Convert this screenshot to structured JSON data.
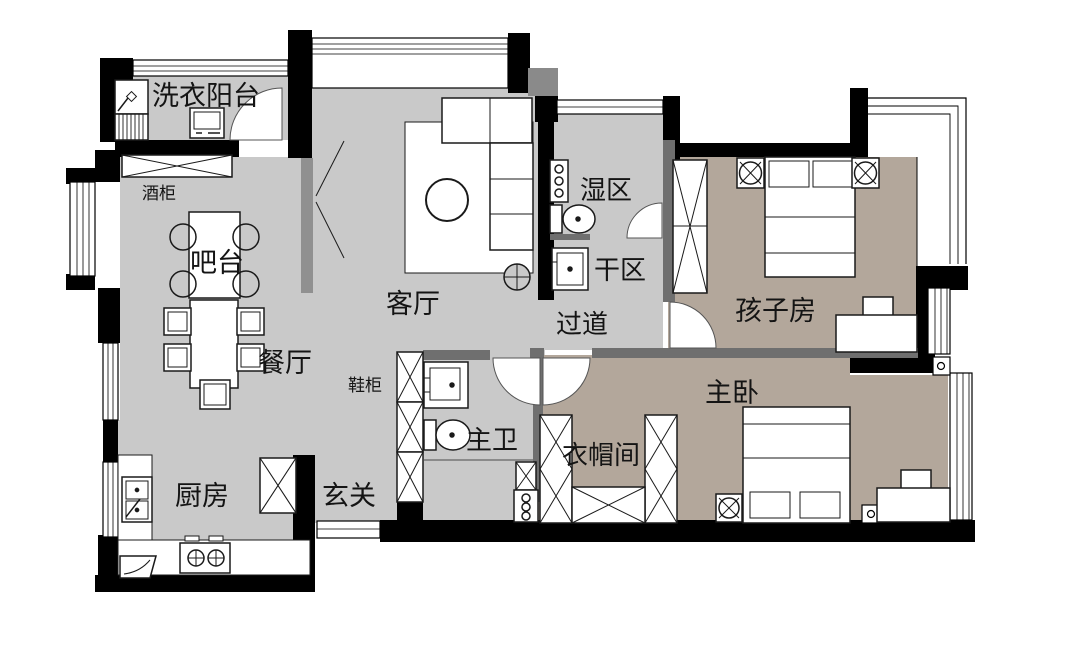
{
  "plan_title": "apartment-floor-plan",
  "colors": {
    "floor_light": "#c9c9c9",
    "floor_taupe": "#b3a79b",
    "wall_black": "#000000",
    "wall_gray": "#6f6f6f",
    "furniture_fill": "#ffffff",
    "line": "#1a1a1a"
  },
  "rooms": [
    {
      "id": "laundry-balcony",
      "label": "洗衣阳台"
    },
    {
      "id": "wine-cabinet",
      "label": "酒柜"
    },
    {
      "id": "bar-counter",
      "label": "吧台"
    },
    {
      "id": "dining-room",
      "label": "餐厅"
    },
    {
      "id": "living-room",
      "label": "客厅"
    },
    {
      "id": "wet-area",
      "label": "湿区"
    },
    {
      "id": "dry-area",
      "label": "干区"
    },
    {
      "id": "hallway",
      "label": "过道"
    },
    {
      "id": "kids-room",
      "label": "孩子房"
    },
    {
      "id": "master-bedroom",
      "label": "主卧"
    },
    {
      "id": "master-bath",
      "label": "主卫"
    },
    {
      "id": "cloakroom",
      "label": "衣帽间"
    },
    {
      "id": "shoe-cabinet",
      "label": "鞋柜"
    },
    {
      "id": "kitchen",
      "label": "厨房"
    },
    {
      "id": "entry",
      "label": "玄关"
    }
  ]
}
